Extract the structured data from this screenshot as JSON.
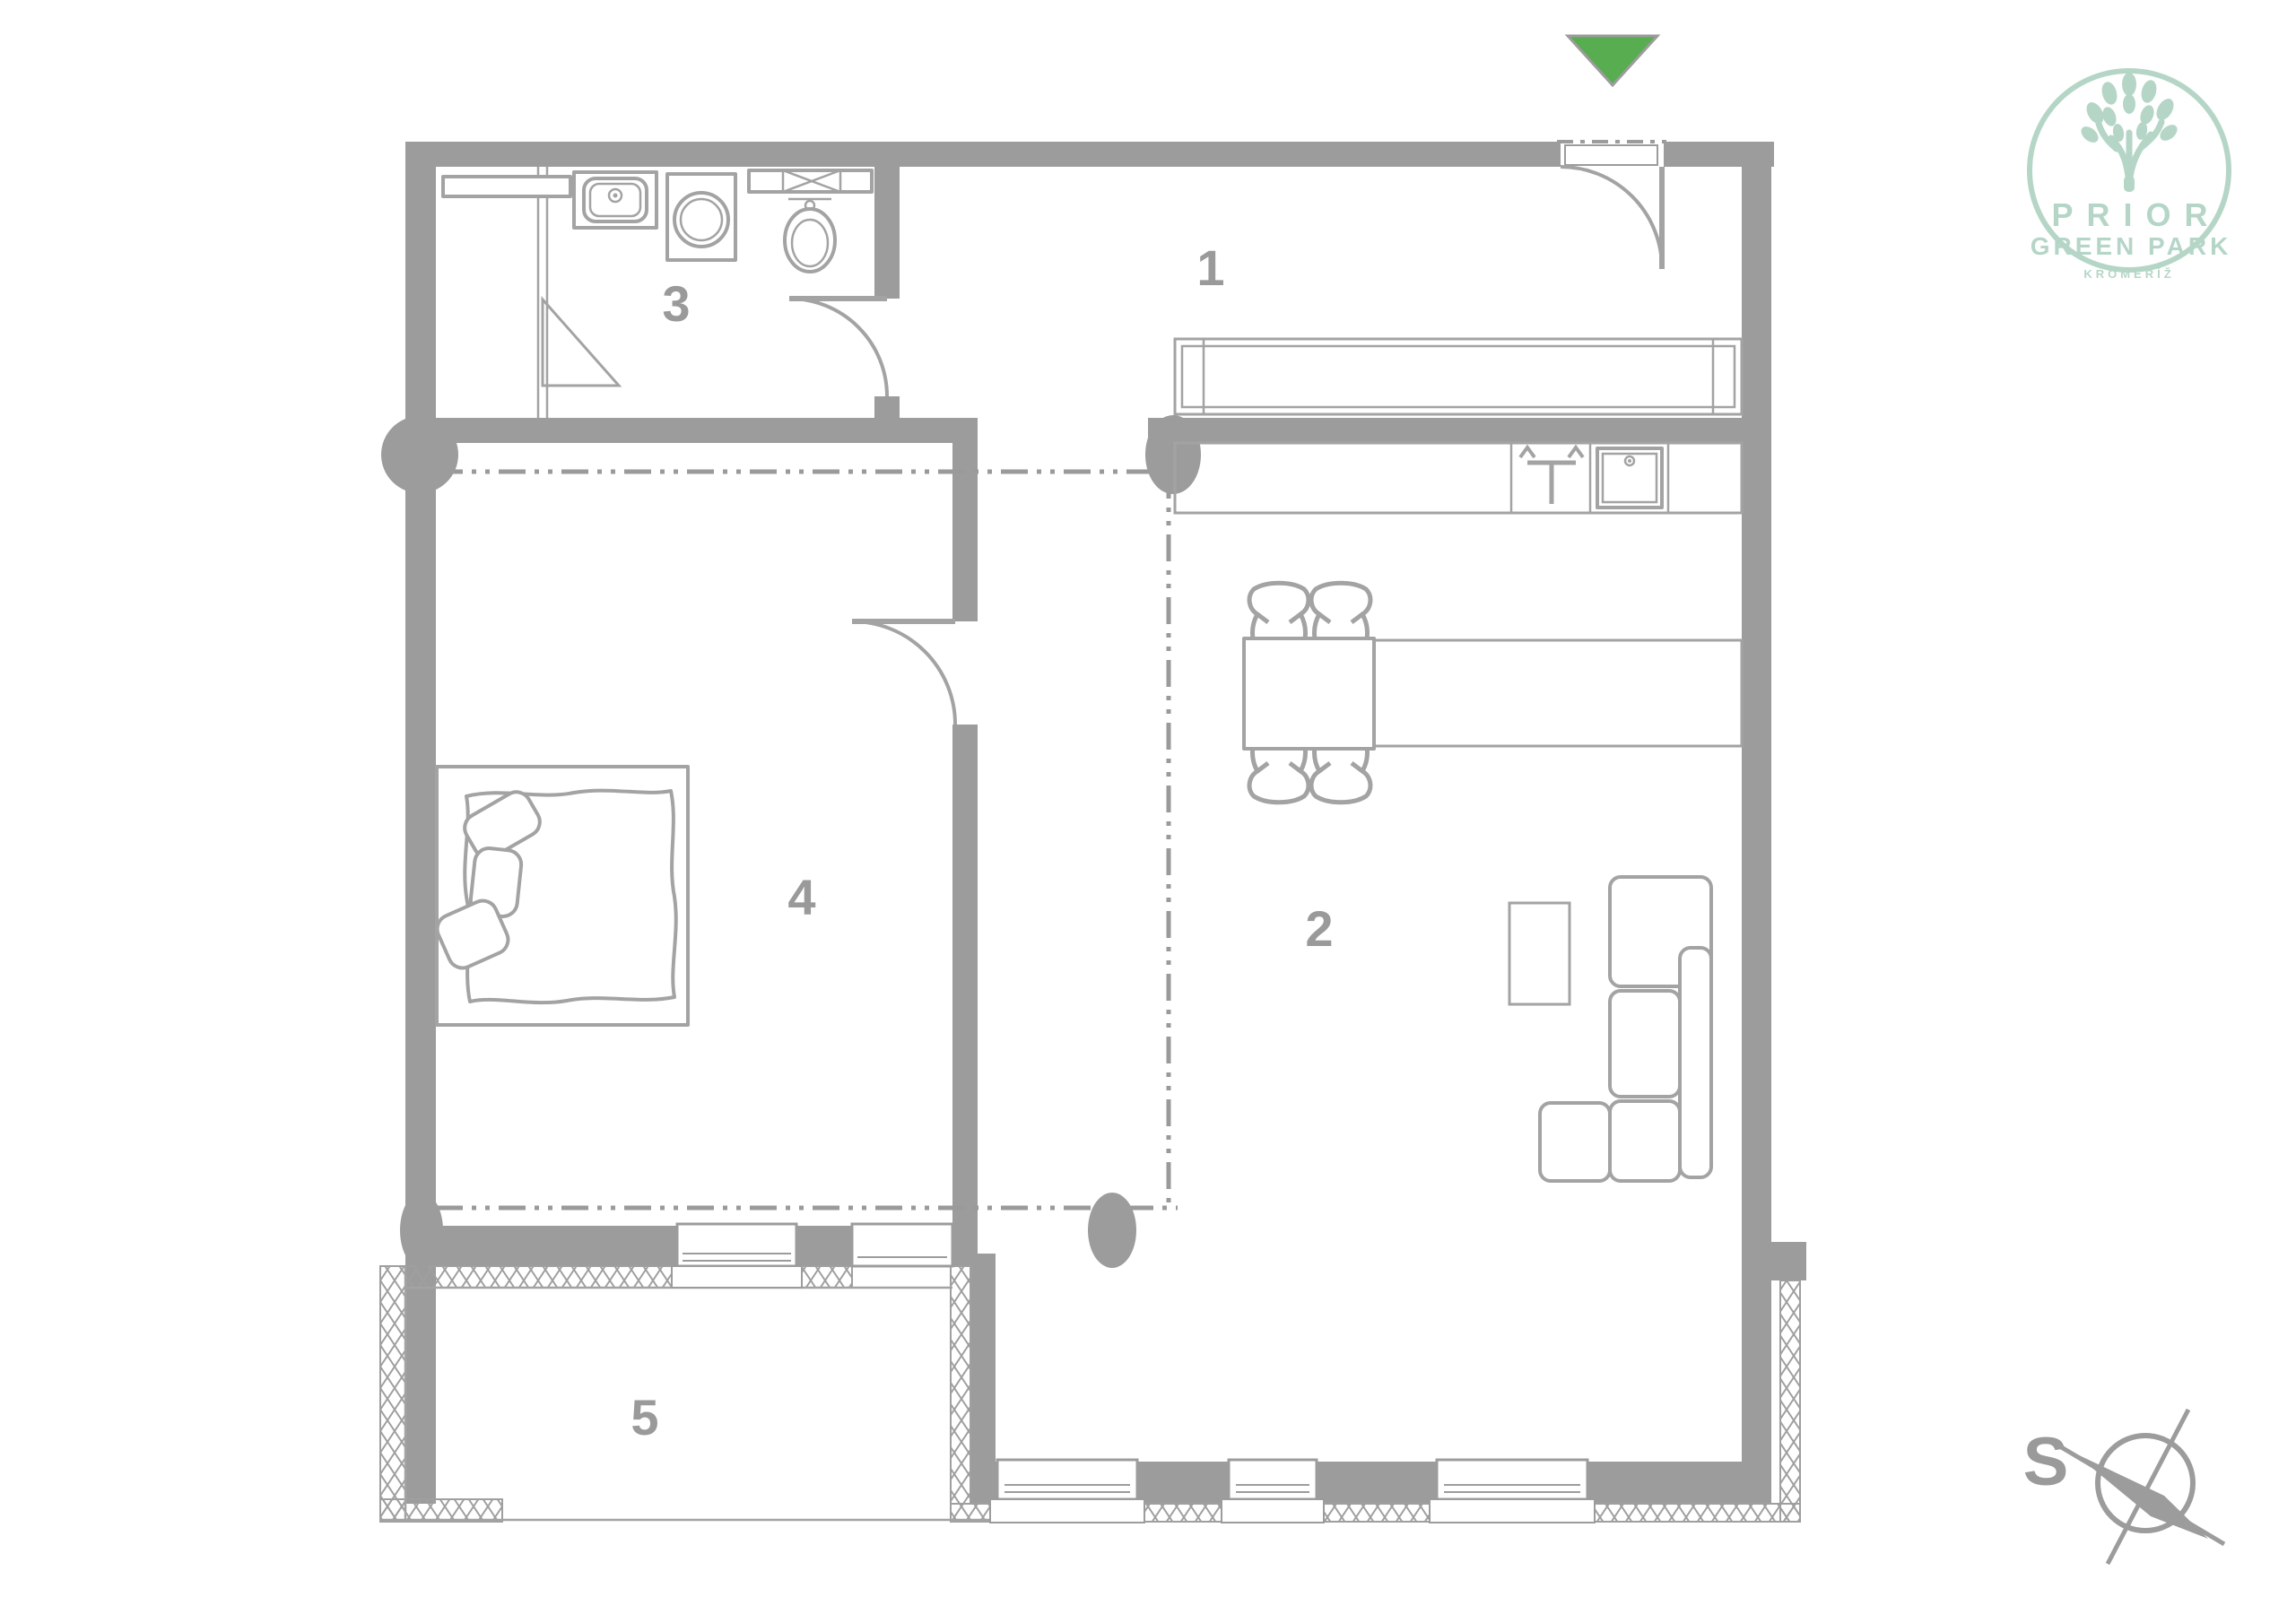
{
  "plan": {
    "rooms": [
      {
        "number": "1"
      },
      {
        "number": "2"
      },
      {
        "number": "3"
      },
      {
        "number": "4"
      },
      {
        "number": "5"
      }
    ]
  },
  "compass": {
    "north_label": "S"
  },
  "logo": {
    "brand": "PRIOR",
    "subtitle": "GREEN PARK",
    "city": "KROMĚŘÍŽ"
  },
  "colors": {
    "wall_gray": "#9c9c9c",
    "fixture_gray": "#a3a3a3",
    "label_gray": "#9a9a9a",
    "entrance_green": "#57ad4f",
    "logo_mint": "#b5d6c7",
    "background": "#ffffff"
  },
  "icons": {
    "entrance_marker": "green-triangle-down",
    "north_arrow": "compass-rose",
    "logo_mark": "tree"
  }
}
